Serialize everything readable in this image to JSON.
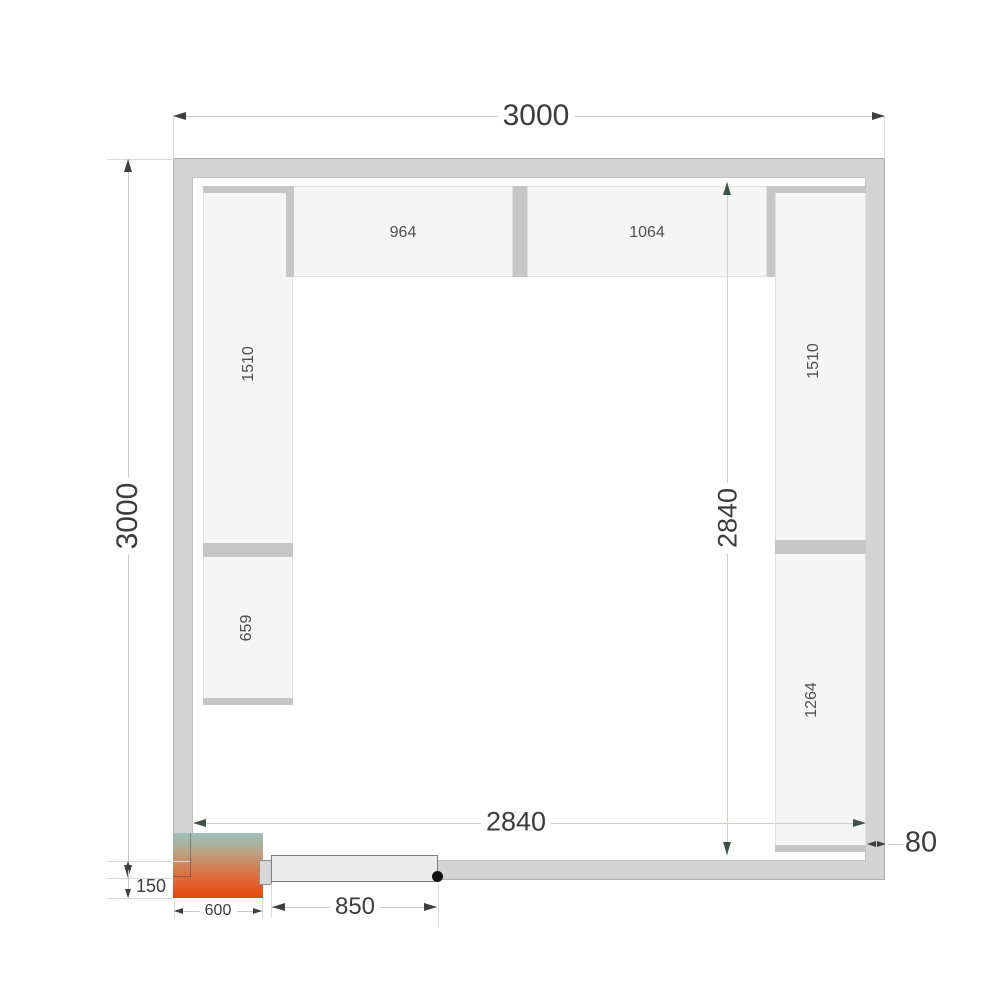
{
  "diagram": {
    "type": "cold-room floor plan, top view, with shelving, door and cooling unit",
    "labels": {
      "overall_width": "3000",
      "overall_depth": "3000",
      "inner_width": "2840",
      "inner_depth": "2840",
      "top_shelf_left": "964",
      "top_shelf_right": "1064",
      "left_shelf_upper": "1510",
      "left_shelf_lower": "659",
      "right_shelf_upper": "1510",
      "right_shelf_lower": "1264",
      "wall_thickness": "80",
      "unit_protrusion": "150",
      "unit_width": "600",
      "door_width": "850"
    },
    "colors": {
      "wall_fill": "#d3d3d3",
      "wall_edge": "#b0b0b0",
      "shelf_fill": "#f5f5f5",
      "shelf_bar": "#c6c6c6",
      "dim_line": "#c9c9c9",
      "dim_text": "#3c3c3c",
      "outer_arrow": "#3f3f3f",
      "inner_arrow": "#3d5248",
      "unit_gradient_top": "#9cc0bb",
      "unit_gradient_bottom": "#e34a14",
      "door_fill": "#ececec",
      "door_edge": "#7d7d7d",
      "hinge_dot": "#111111"
    }
  }
}
